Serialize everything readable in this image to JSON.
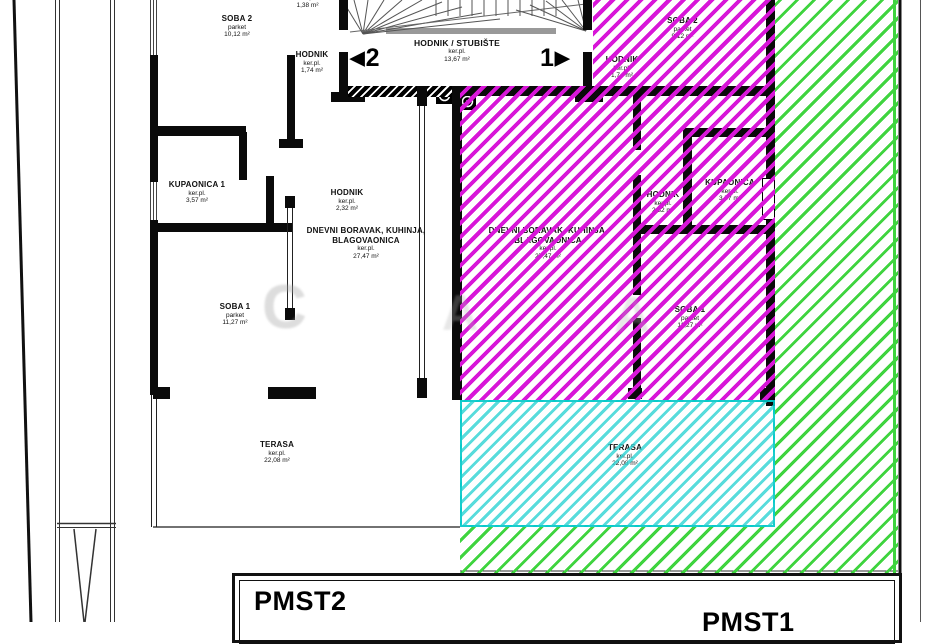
{
  "watermark": {
    "letters": [
      "C",
      "A",
      "A"
    ]
  },
  "markers": {
    "left": {
      "arrow": "◀",
      "num": "2"
    },
    "right": {
      "num": "1",
      "arrow": "▶"
    }
  },
  "parking": {
    "left": "PMST2",
    "right": "PMST1"
  },
  "colors": {
    "magenta": "#d816d8",
    "green": "#3fd43f",
    "cyan": "#2ed3d3",
    "wall": "#000000"
  },
  "rooms": [
    {
      "name": "SOBA 2",
      "floor": "parket",
      "area": "10,12 m²"
    },
    {
      "name": "",
      "floor": "ker.pl.",
      "area": "1,38 m²"
    },
    {
      "name": "HODNIK",
      "floor": "ker.pl.",
      "area": "1,74 m²"
    },
    {
      "name": "HODNIK / STUBIŠTE",
      "floor": "ker.pl.",
      "area": "13,67 m²"
    },
    {
      "name": "KUPAONICA 1",
      "floor": "ker.pl.",
      "area": "3,57 m²"
    },
    {
      "name": "HODNIK",
      "floor": "ker.pl.",
      "area": "2,32 m²"
    },
    {
      "name": "DNEVNI BORAVAK, KUHINJA, BLAGOVAONICA",
      "floor": "ker.pl.",
      "area": "27,47 m²"
    },
    {
      "name": "SOBA 1",
      "floor": "parket",
      "area": "11,27 m²"
    },
    {
      "name": "TERASA",
      "floor": "ker.pl.",
      "area": "22,08 m²"
    },
    {
      "name": "SOBA 2",
      "floor": "parket",
      "area": "9,12 m²"
    },
    {
      "name": "HODNIK",
      "floor": "ker.pl.",
      "area": "1,74 m²"
    },
    {
      "name": "DNEVNI BORAVAK, KUHINJA, BLAGOVAONICA",
      "floor": "ker.pl.",
      "area": "27,47 m²"
    },
    {
      "name": "HODNIK",
      "floor": "ker.pl.",
      "area": "2,32 m²"
    },
    {
      "name": "KUPAONICA",
      "floor": "ker.pl.",
      "area": "3,57 m²"
    },
    {
      "name": "SOBA 1",
      "floor": "parket",
      "area": "11,27 m²"
    },
    {
      "name": "TERASA",
      "floor": "ker.pl.",
      "area": "22,08 m²"
    }
  ]
}
